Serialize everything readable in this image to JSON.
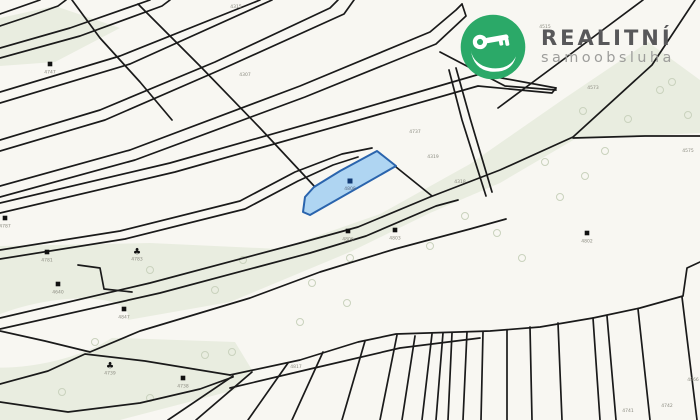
{
  "logo": {
    "title": "REALITNÍ",
    "subtitle": "samoobsluha",
    "circle_color": "#2ba968",
    "icon": "key-in-hand-icon",
    "title_color": "#58585a",
    "subtitle_color": "#9d9d9b"
  },
  "map": {
    "type": "cadastral-parcel-map",
    "colors": {
      "background": "#f8f7f2",
      "line": "#1a1a1a",
      "green": "#e9ede0",
      "tree": "#c9d2bd",
      "label": "#8b8b80",
      "marker": "#111111",
      "highlight_fill": "#a6d0f2",
      "highlight_stroke": "#2a64ad",
      "highlight_marker": "#123a75"
    },
    "highlighted_parcel": {
      "number": "4808",
      "polygon": [
        [
          377,
          151
        ],
        [
          396,
          166
        ],
        [
          310,
          215
        ],
        [
          303,
          212
        ],
        [
          305,
          197
        ],
        [
          314,
          187
        ],
        [
          340,
          171
        ]
      ],
      "marker": [
        350,
        181
      ]
    },
    "green_areas": [
      [
        [
          648,
          42
        ],
        [
          700,
          80
        ],
        [
          700,
          133
        ],
        [
          575,
          139
        ],
        [
          500,
          183
        ],
        [
          430,
          213
        ],
        [
          350,
          252
        ],
        [
          230,
          302
        ],
        [
          60,
          332
        ],
        [
          0,
          334
        ],
        [
          0,
          246
        ],
        [
          150,
          243
        ],
        [
          280,
          249
        ],
        [
          380,
          214
        ],
        [
          470,
          164
        ],
        [
          565,
          98
        ]
      ],
      [
        [
          0,
          336
        ],
        [
          120,
          338
        ],
        [
          235,
          342
        ],
        [
          252,
          370
        ],
        [
          235,
          390
        ],
        [
          120,
          420
        ],
        [
          0,
          420
        ]
      ],
      [
        [
          0,
          18
        ],
        [
          55,
          6
        ],
        [
          120,
          28
        ],
        [
          55,
          62
        ],
        [
          0,
          66
        ]
      ]
    ],
    "white_patch": {
      "cx": 42,
      "cy": 333,
      "rx": 88,
      "ry": 30,
      "rot": -12
    },
    "lines": [
      {
        "p": [
          [
            0,
            14
          ],
          [
            40,
            0
          ]
        ]
      },
      {
        "p": [
          [
            0,
            26
          ],
          [
            30,
            16
          ],
          [
            58,
            6
          ],
          [
            66,
            0
          ]
        ]
      },
      {
        "p": [
          [
            0,
            48
          ],
          [
            70,
            28
          ],
          [
            150,
            0
          ]
        ]
      },
      {
        "p": [
          [
            0,
            58
          ],
          [
            80,
            36
          ],
          [
            162,
            6
          ],
          [
            170,
            0
          ]
        ]
      },
      {
        "p": [
          [
            0,
            92
          ],
          [
            120,
            56
          ],
          [
            260,
            0
          ]
        ]
      },
      {
        "p": [
          [
            0,
            103
          ],
          [
            130,
            64
          ],
          [
            272,
            0
          ]
        ]
      },
      {
        "p": [
          [
            0,
            140
          ],
          [
            100,
            110
          ],
          [
            215,
            62
          ],
          [
            330,
            8
          ],
          [
            338,
            0
          ]
        ]
      },
      {
        "p": [
          [
            0,
            151
          ],
          [
            105,
            120
          ],
          [
            220,
            70
          ],
          [
            344,
            14
          ],
          [
            354,
            0
          ]
        ]
      },
      {
        "p": [
          [
            0,
            186
          ],
          [
            130,
            150
          ],
          [
            300,
            86
          ],
          [
            430,
            32
          ],
          [
            456,
            10
          ],
          [
            462,
            4
          ]
        ]
      },
      {
        "p": [
          [
            0,
            197
          ],
          [
            135,
            160
          ],
          [
            305,
            97
          ],
          [
            436,
            44
          ],
          [
            466,
            16
          ],
          [
            462,
            4
          ]
        ]
      },
      {
        "p": [
          [
            72,
            0
          ],
          [
            100,
            38
          ],
          [
            140,
            82
          ],
          [
            172,
            120
          ]
        ]
      },
      {
        "p": [
          [
            138,
            4
          ],
          [
            200,
            66
          ],
          [
            260,
            128
          ],
          [
            315,
            187
          ]
        ]
      },
      {
        "p": [
          [
            0,
            203
          ],
          [
            170,
            163
          ],
          [
            350,
            112
          ],
          [
            480,
            74
          ],
          [
            556,
            88
          ]
        ]
      },
      {
        "p": [
          [
            0,
            213
          ],
          [
            175,
            172
          ],
          [
            352,
            122
          ],
          [
            478,
            86
          ],
          [
            552,
            93
          ],
          [
            556,
            88
          ]
        ]
      },
      {
        "p": [
          [
            440,
            52
          ],
          [
            505,
            86
          ],
          [
            556,
            90
          ]
        ]
      },
      {
        "p": [
          [
            498,
            108
          ],
          [
            560,
            62
          ],
          [
            600,
            32
          ],
          [
            643,
            0
          ]
        ]
      },
      {
        "p": [
          [
            0,
            250
          ],
          [
            120,
            231
          ],
          [
            240,
            201
          ],
          [
            295,
            172
          ],
          [
            342,
            154
          ],
          [
            372,
            148
          ]
        ]
      },
      {
        "p": [
          [
            0,
            259
          ],
          [
            125,
            239
          ],
          [
            245,
            209
          ],
          [
            298,
            181
          ],
          [
            333,
            165
          ],
          [
            358,
            157
          ]
        ]
      },
      {
        "p": [
          [
            0,
            318
          ],
          [
            150,
            283
          ],
          [
            300,
            243
          ],
          [
            358,
            227
          ],
          [
            430,
            197
          ],
          [
            500,
            170
          ],
          [
            573,
            137
          ],
          [
            652,
            65
          ],
          [
            695,
            0
          ]
        ]
      },
      {
        "p": [
          [
            0,
            329
          ],
          [
            160,
            293
          ],
          [
            310,
            253
          ],
          [
            366,
            236
          ],
          [
            436,
            206
          ],
          [
            458,
            200
          ]
        ]
      },
      {
        "p": [
          [
            0,
            331
          ],
          [
            45,
            341
          ],
          [
            90,
            352
          ],
          [
            140,
            331
          ],
          [
            190,
            316
          ],
          [
            250,
            298
          ],
          [
            320,
            272
          ],
          [
            395,
            249
          ],
          [
            470,
            229
          ],
          [
            506,
            219
          ]
        ]
      },
      {
        "p": [
          [
            0,
            384
          ],
          [
            48,
            371
          ],
          [
            85,
            354
          ],
          [
            145,
            361
          ],
          [
            230,
            375
          ]
        ]
      },
      {
        "p": [
          [
            0,
            402
          ],
          [
            68,
            412
          ],
          [
            140,
            403
          ],
          [
            200,
            389
          ],
          [
            233,
            377
          ]
        ]
      },
      {
        "p": [
          [
            230,
            375
          ],
          [
            300,
            360
          ],
          [
            358,
            342
          ],
          [
            396,
            334
          ],
          [
            490,
            331
          ],
          [
            540,
            327
          ],
          [
            593,
            318
          ],
          [
            640,
            308
          ],
          [
            683,
            296
          ],
          [
            687,
            268
          ],
          [
            700,
            262
          ]
        ]
      },
      {
        "p": [
          [
            230,
            388
          ],
          [
            310,
            369
          ],
          [
            400,
            348
          ],
          [
            480,
            338
          ]
        ]
      },
      {
        "p": [
          [
            573,
            138
          ],
          [
            645,
            136
          ],
          [
            700,
            136
          ]
        ]
      },
      {
        "p": [
          [
            449,
            70
          ],
          [
            462,
            120
          ],
          [
            486,
            196
          ]
        ]
      },
      {
        "p": [
          [
            456,
            68
          ],
          [
            470,
            118
          ],
          [
            492,
            192
          ]
        ]
      },
      {
        "p": [
          [
            396,
            167
          ],
          [
            432,
            196
          ]
        ]
      },
      {
        "p": [
          [
            78,
            265
          ],
          [
            100,
            268
          ],
          [
            104,
            289
          ],
          [
            132,
            292
          ]
        ]
      }
    ],
    "fan_lines": [
      [
        233,
        376,
        168,
        420
      ],
      [
        252,
        372,
        196,
        420
      ],
      [
        288,
        363,
        248,
        420
      ],
      [
        323,
        352,
        292,
        420
      ],
      [
        365,
        341,
        342,
        420
      ],
      [
        397,
        335,
        380,
        420
      ],
      [
        415,
        336,
        402,
        420
      ],
      [
        432,
        334,
        422,
        420
      ],
      [
        443,
        333,
        436,
        420
      ],
      [
        452,
        333,
        448,
        420
      ],
      [
        467,
        332,
        463,
        420
      ],
      [
        483,
        332,
        481,
        420
      ],
      [
        507,
        330,
        507,
        420
      ],
      [
        530,
        327,
        532,
        420
      ],
      [
        558,
        323,
        562,
        420
      ],
      [
        593,
        318,
        600,
        420
      ],
      [
        607,
        316,
        616,
        420
      ],
      [
        638,
        309,
        650,
        420
      ],
      [
        682,
        297,
        697,
        420
      ]
    ],
    "building_markers": [
      {
        "type": "square",
        "x": 50,
        "y": 64,
        "label": "4747"
      },
      {
        "type": "square",
        "x": 5,
        "y": 218,
        "label": "4787"
      },
      {
        "type": "square",
        "x": 47,
        "y": 252,
        "label": "4781"
      },
      {
        "type": "square",
        "x": 58,
        "y": 284,
        "label": "4640"
      },
      {
        "type": "square",
        "x": 124,
        "y": 309,
        "label": "4847"
      },
      {
        "type": "square",
        "x": 183,
        "y": 378,
        "label": "4738"
      },
      {
        "type": "square",
        "x": 348,
        "y": 231,
        "label": "4806"
      },
      {
        "type": "square",
        "x": 395,
        "y": 230,
        "label": "4803"
      },
      {
        "type": "square",
        "x": 587,
        "y": 233,
        "label": "4802"
      },
      {
        "type": "club",
        "x": 137,
        "y": 251,
        "label": "4783"
      },
      {
        "type": "club",
        "x": 110,
        "y": 365,
        "label": "4739"
      }
    ],
    "parcel_labels": [
      {
        "x": 245,
        "y": 76,
        "text": "4307"
      },
      {
        "x": 236,
        "y": 8,
        "text": "4315"
      },
      {
        "x": 415,
        "y": 133,
        "text": "4737"
      },
      {
        "x": 433,
        "y": 158,
        "text": "4319"
      },
      {
        "x": 460,
        "y": 183,
        "text": "4318"
      },
      {
        "x": 593,
        "y": 89,
        "text": "4573"
      },
      {
        "x": 545,
        "y": 28,
        "text": "4515"
      },
      {
        "x": 688,
        "y": 152,
        "text": "4575"
      },
      {
        "x": 628,
        "y": 412,
        "text": "4741"
      },
      {
        "x": 667,
        "y": 407,
        "text": "4742"
      },
      {
        "x": 693,
        "y": 381,
        "text": "4866"
      },
      {
        "x": 296,
        "y": 368,
        "text": "4817"
      }
    ],
    "tree_symbols": [
      [
        150,
        270
      ],
      [
        215,
        290
      ],
      [
        243,
        260
      ],
      [
        312,
        283
      ],
      [
        347,
        303
      ],
      [
        300,
        322
      ],
      [
        430,
        246
      ],
      [
        465,
        216
      ],
      [
        497,
        233
      ],
      [
        522,
        258
      ],
      [
        545,
        162
      ],
      [
        560,
        197
      ],
      [
        585,
        176
      ],
      [
        605,
        151
      ],
      [
        628,
        119
      ],
      [
        583,
        111
      ],
      [
        350,
        258
      ],
      [
        95,
        342
      ],
      [
        62,
        392
      ],
      [
        150,
        398
      ],
      [
        205,
        355
      ],
      [
        232,
        352
      ],
      [
        660,
        90
      ],
      [
        688,
        115
      ],
      [
        672,
        82
      ]
    ]
  }
}
